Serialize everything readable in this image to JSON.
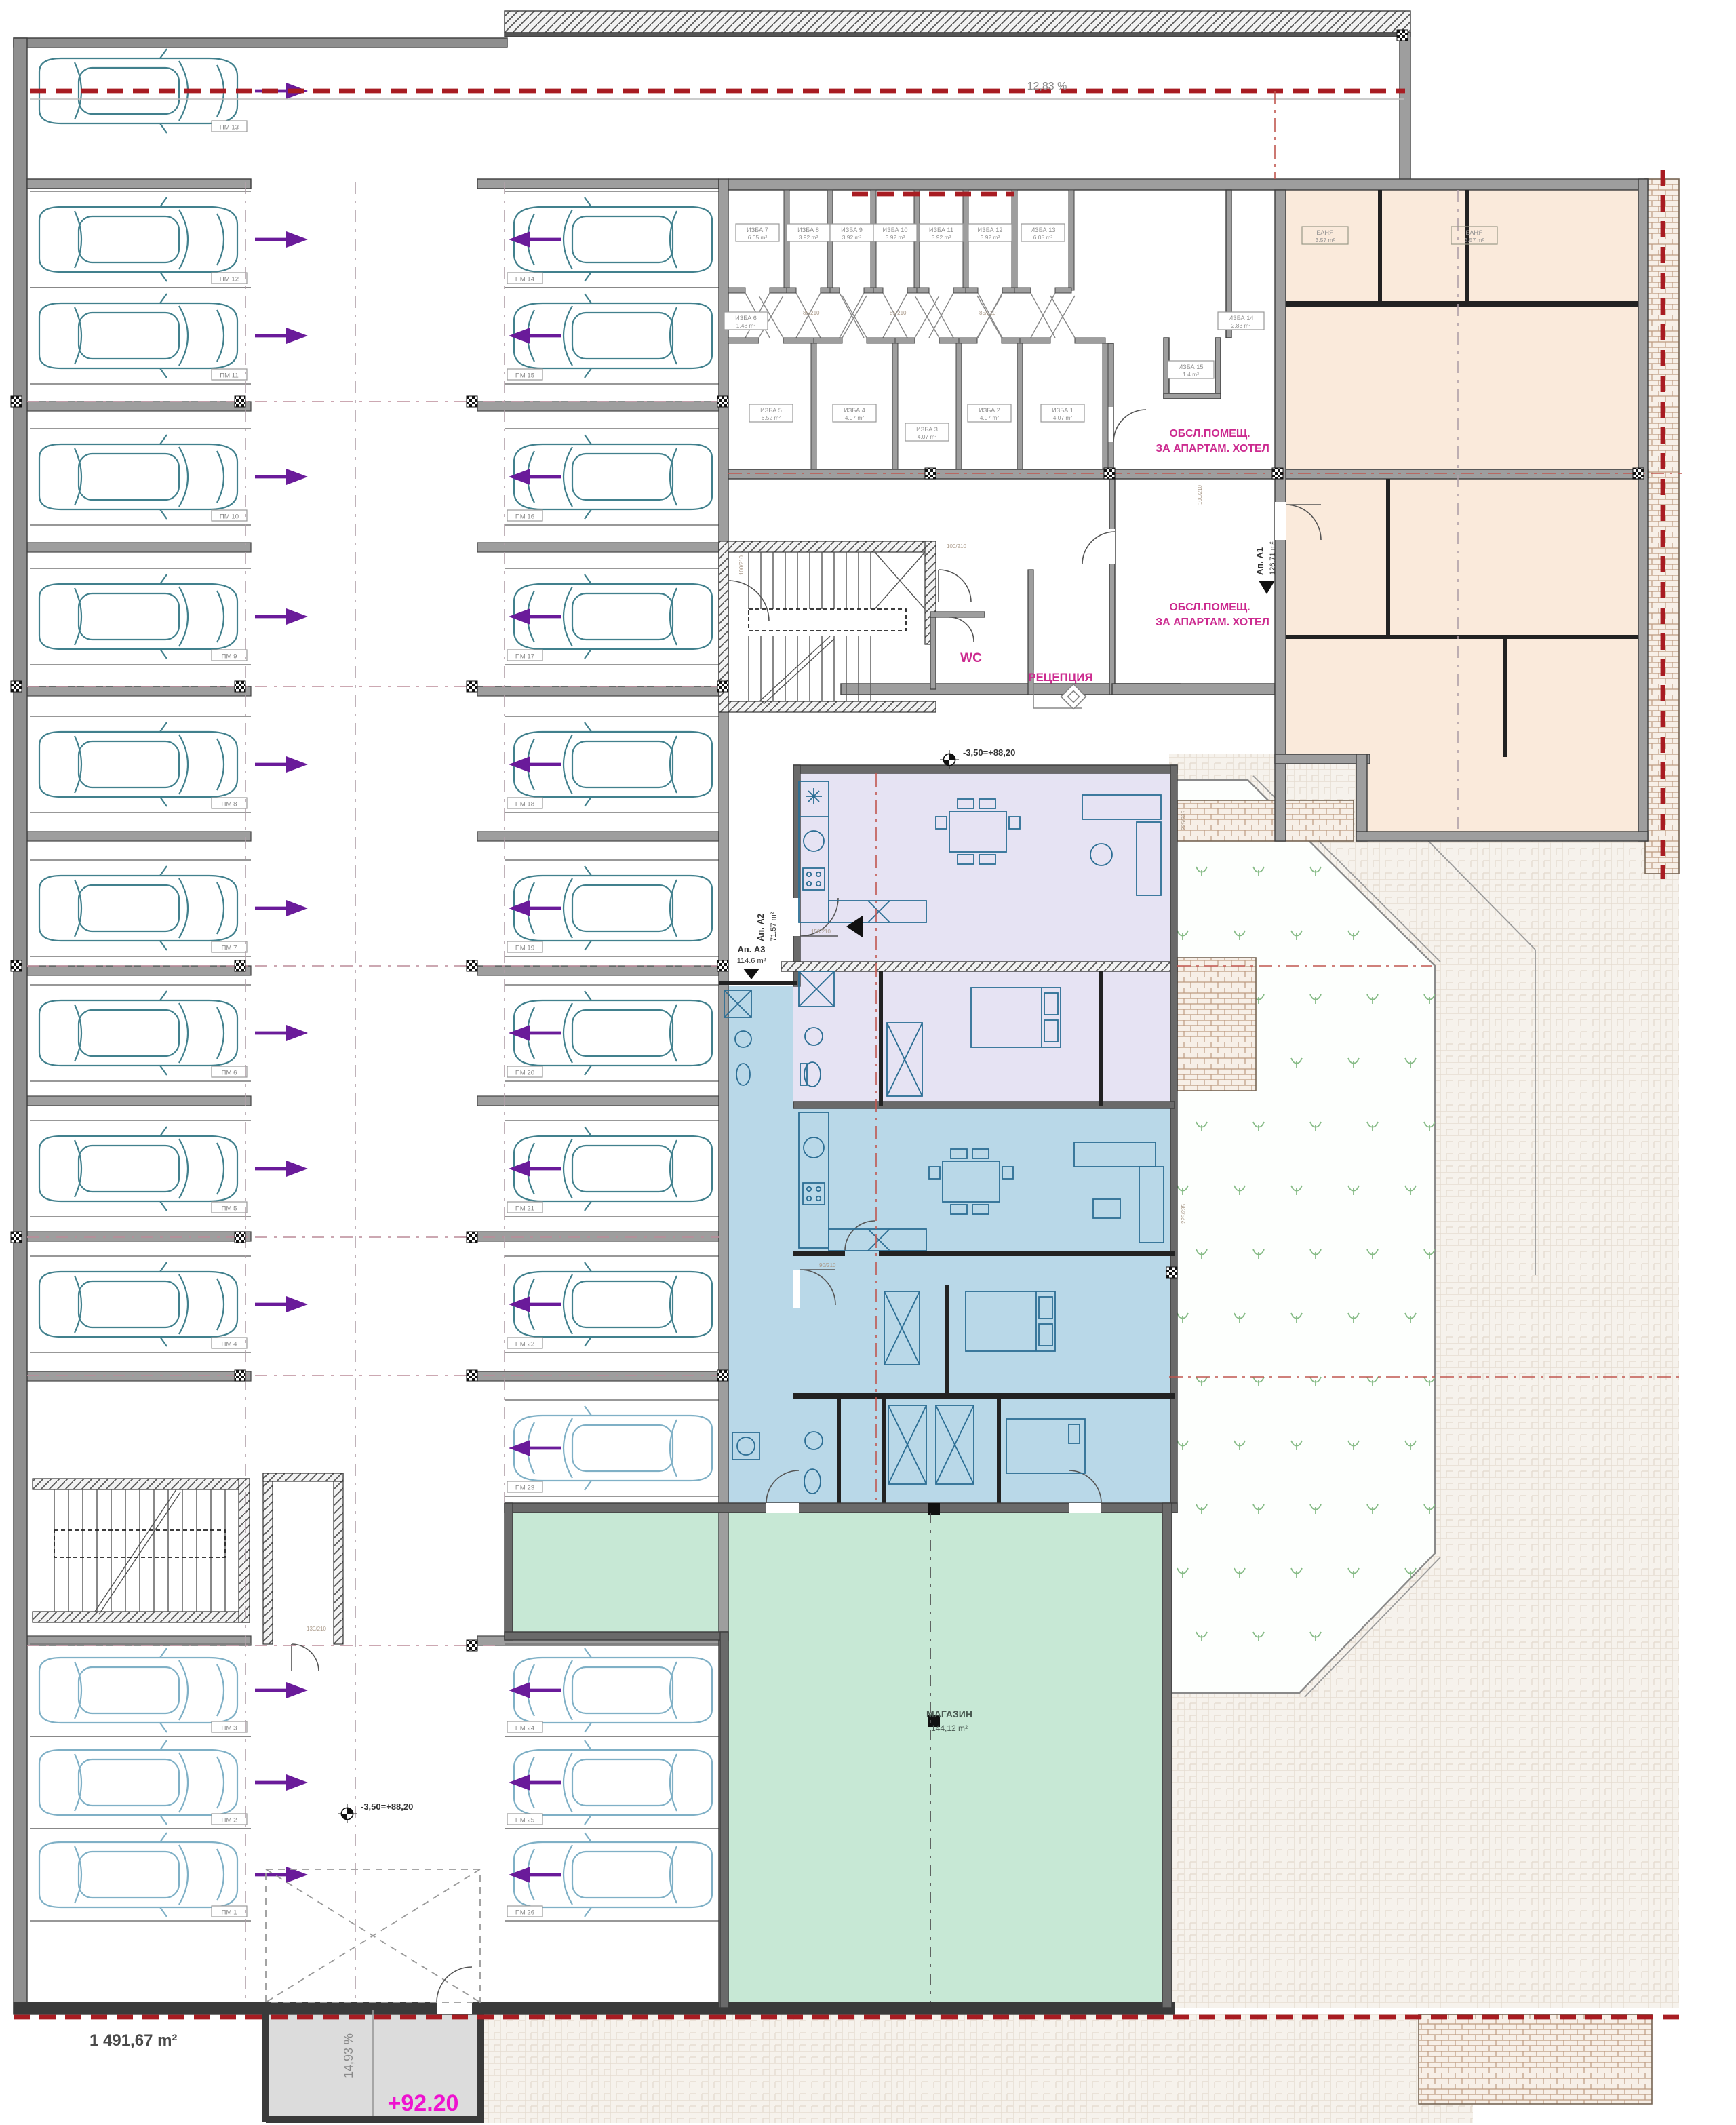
{
  "labels": {
    "slope_top": "12,83 %",
    "slope_bottom": "14,93 %",
    "level_street": "+92.20",
    "total_area": "1 491,67 m²",
    "level_mark": "-3,50=+88,20",
    "wc": "WC",
    "reception": "РЕЦЕПЦИЯ",
    "service_line1": "ОБСЛ.ПОМЕЩ.",
    "service_line2": "ЗА АПАРТАМ. ХОТЕЛ",
    "shop_name": "МАГАЗИН",
    "shop_area": "144,12 m²"
  },
  "apartments": {
    "a1": {
      "name": "Ап. А1",
      "area": "126.71 m²"
    },
    "a2": {
      "name": "Ап. А2",
      "area": "71.57 m²"
    },
    "a3": {
      "name": "Ап. А3",
      "area": "114.6 m²"
    }
  },
  "storage": {
    "row1": [
      {
        "name": "ИЗБА 7",
        "area": "6.05 m²"
      },
      {
        "name": "ИЗБА 8",
        "area": "3.92 m²"
      },
      {
        "name": "ИЗБА 9",
        "area": "3.92 m²"
      },
      {
        "name": "ИЗБА 10",
        "area": "3.92 m²"
      },
      {
        "name": "ИЗБА 11",
        "area": "3.92 m²"
      },
      {
        "name": "ИЗБА 12",
        "area": "3.92 m²"
      },
      {
        "name": "ИЗБА 13",
        "area": "6.05 m²"
      }
    ],
    "row2": [
      {
        "name": "ИЗБА 5",
        "area": "6.52 m²"
      },
      {
        "name": "ИЗБА 4",
        "area": "4.07 m²"
      },
      {
        "name": "ИЗБА 3",
        "area": "4.07 m²"
      },
      {
        "name": "ИЗБА 2",
        "area": "4.07 m²"
      },
      {
        "name": "ИЗБА 1",
        "area": "4.07 m²"
      }
    ],
    "side": {
      "izba6": {
        "name": "ИЗБА 6",
        "area": "1.48 m²"
      },
      "izba14": {
        "name": "ИЗБА 14",
        "area": "2.83 m²"
      },
      "izba15": {
        "name": "ИЗБА 15",
        "area": "1.4 m²"
      }
    }
  },
  "bathrooms": [
    {
      "name": "БАНЯ",
      "area": "3.57 m²"
    },
    {
      "name": "БАНЯ",
      "area": "3.57 m²"
    }
  ],
  "parking": {
    "left": [
      "ПМ 13",
      "ПМ 12",
      "ПМ 11",
      "ПМ 10",
      "ПМ 9",
      "ПМ 8",
      "ПМ 7",
      "ПМ 6",
      "ПМ 5",
      "ПМ 4",
      "ПМ 3",
      "ПМ 2",
      "ПМ 1"
    ],
    "middle": [
      "ПМ 14",
      "ПМ 15",
      "ПМ 16",
      "ПМ 17",
      "ПМ 18",
      "ПМ 19",
      "ПМ 20",
      "ПМ 21",
      "ПМ 22",
      "ПМ 23",
      "ПМ 24",
      "ПМ 25",
      "ПМ 26"
    ]
  },
  "dims": {
    "d85": "85/210",
    "d90": "90/210",
    "d100": "100/210",
    "d130": "130/210",
    "d150": "150/210",
    "w225": "225/235"
  },
  "colors": {
    "wall": "#9e9e9e",
    "beige": "#faeadb",
    "lavender": "#e6e3f3",
    "blue": "#b9d8e8",
    "green": "#c7e8d5",
    "ramp": "#dcdcdc",
    "car": "#41808d",
    "car_light": "#7fb0c6",
    "arrow": "#6a1b9a",
    "red_dash": "#a81c22",
    "magenta": "#cc2a8f",
    "level_magenta": "#ee12cf",
    "furniture": "#2c6e94"
  }
}
